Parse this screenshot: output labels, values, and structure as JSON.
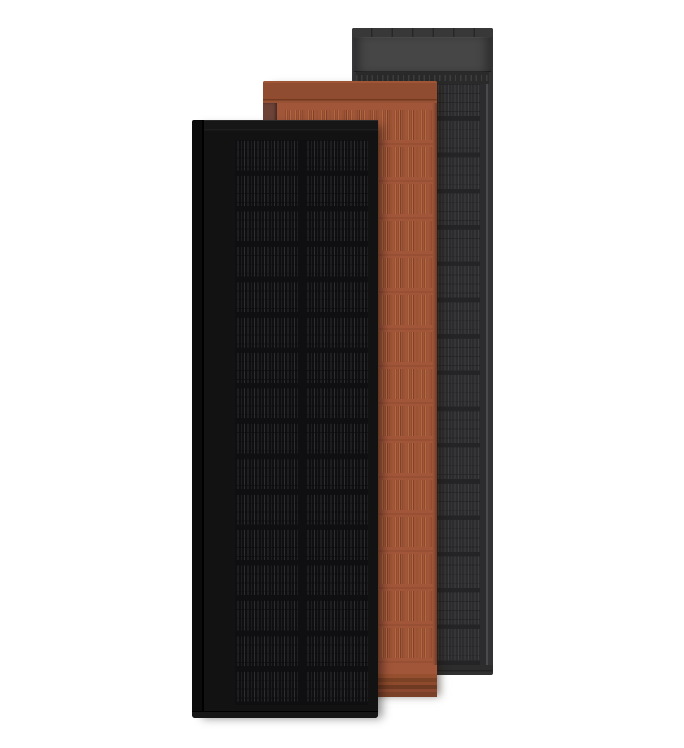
{
  "scene": {
    "type": "product-render",
    "description": "Three overlapping upright rooftop solar tiles shown on a plain white background: a black tile in front, a terracotta ribbed tile in the middle, and a slate-gray tile at the back",
    "background": "#ffffff"
  },
  "panels": [
    {
      "name": "slate-gray-solar-tile",
      "depth": "back",
      "geometry": {
        "left": 352,
        "top": 28,
        "width": 141,
        "height": 647
      },
      "colors": {
        "frame": "#333336",
        "frameLine": "#4a4a4c",
        "topbar": "#2e2e2e",
        "header": "#464646",
        "ridge": "#2a2a2a",
        "cells": "#2c2c2e",
        "busbar": "#3e3e40",
        "rowgap": "#242426",
        "bottombar": "#2d2d2d"
      }
    },
    {
      "name": "terracotta-solar-tile",
      "depth": "middle",
      "geometry": {
        "left": 263,
        "top": 81,
        "width": 174,
        "height": 616
      },
      "colors": {
        "base": "#a1563a",
        "band": "#8f4c31",
        "rail": "#6d4338",
        "grooveLight": "#b4683f",
        "grooveDark": "#7f4128",
        "rowline": "#8f4a2f",
        "bottomDark": "#6f3a22"
      }
    },
    {
      "name": "black-solar-tile",
      "depth": "front",
      "geometry": {
        "left": 192,
        "top": 120,
        "width": 186,
        "height": 598
      },
      "colors": {
        "frame": "#121212",
        "cells": "#0f0f11",
        "busbar": "#2e2e30",
        "edge": "#000000"
      }
    }
  ]
}
